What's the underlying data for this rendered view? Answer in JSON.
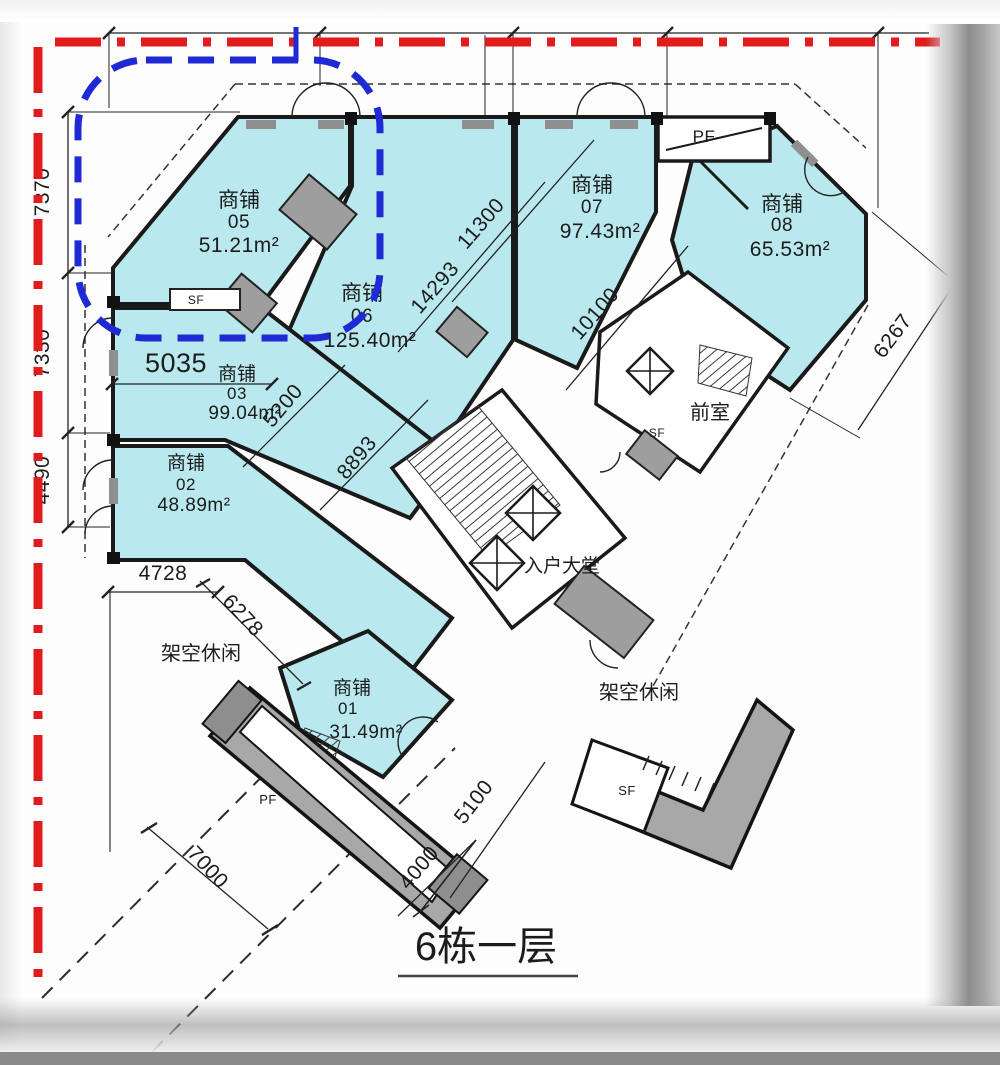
{
  "title": {
    "text": "6栋一层"
  },
  "shops": [
    {
      "type": "商铺",
      "no": "01",
      "area": "31.49m²"
    },
    {
      "type": "商铺",
      "no": "02",
      "area": "48.89m²"
    },
    {
      "type": "商铺",
      "no": "03",
      "area": "99.04m²"
    },
    {
      "type": "商铺",
      "no": "05",
      "area": "51.21m²"
    },
    {
      "type": "商铺",
      "no": "06",
      "area": "125.40m²"
    },
    {
      "type": "商铺",
      "no": "07",
      "area": "97.43m²"
    },
    {
      "type": "商铺",
      "no": "08",
      "area": "65.53m²"
    }
  ],
  "rooms": {
    "lobby": "入户大堂",
    "vestibule": "前室",
    "leisure_left": "架空休闲",
    "leisure_right": "架空休闲",
    "pf_top": "PF",
    "pf_bottom": "PF",
    "sf_shop5": "SF",
    "sf_vestibule": "SF",
    "sf_bottom": "SF"
  },
  "dims": {
    "left": [
      "7370",
      "7330",
      "4490"
    ],
    "d5035": "5035",
    "d5200": "5200",
    "d8893": "8893",
    "d14293": "14293",
    "d11300": "11300",
    "d10100": "10100",
    "d6267": "6267",
    "d4728": "4728",
    "d6278": "6278",
    "d7000": "7000",
    "d4000": "4000",
    "d5100": "5100"
  },
  "colors": {
    "shop_fill": "#b9e9ee",
    "wall": "#1a1a1a",
    "boundary_red": "#e01c1c",
    "highlight_blue": "#1f2ad4",
    "core_gray": "#a8a8a8"
  }
}
